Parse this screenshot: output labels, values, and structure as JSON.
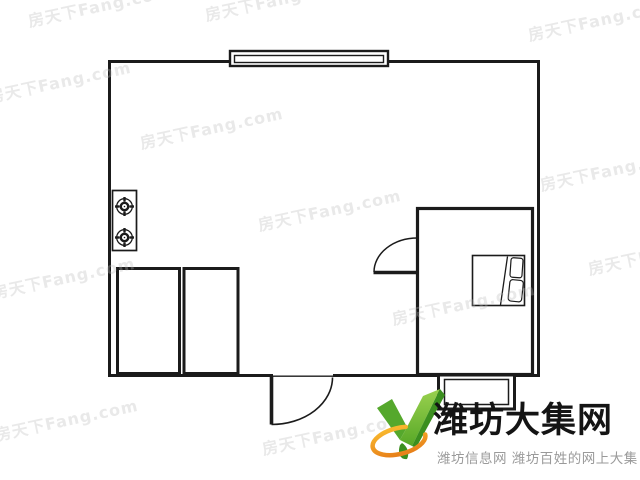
{
  "canvas": {
    "width": 640,
    "height": 480,
    "background": "#ffffff"
  },
  "floorplan": {
    "line_color": "#1b1b1b",
    "fill_color": "#ffffff",
    "elements": [
      {
        "name": "outer-walls",
        "type": "walls"
      },
      {
        "name": "window-top",
        "type": "window"
      },
      {
        "name": "gas-stove",
        "type": "appliance",
        "burners": 2
      },
      {
        "name": "closet-left",
        "type": "furniture"
      },
      {
        "name": "closet-right",
        "type": "furniture"
      },
      {
        "name": "entry-door",
        "type": "door-swing"
      },
      {
        "name": "bedroom",
        "type": "room"
      },
      {
        "name": "bedroom-door",
        "type": "door-swing"
      },
      {
        "name": "bed",
        "type": "furniture",
        "pillows": 2
      },
      {
        "name": "balcony-window",
        "type": "window"
      }
    ]
  },
  "watermark": {
    "text": "房天下Fang.com",
    "color": "rgba(187,187,187,0.32)",
    "rotation_deg": -12,
    "font_size": 16,
    "positions": [
      [
        28,
        8
      ],
      [
        205,
        2
      ],
      [
        528,
        22
      ],
      [
        -12,
        84
      ],
      [
        140,
        130
      ],
      [
        540,
        172
      ],
      [
        258,
        212
      ],
      [
        -8,
        280
      ],
      [
        392,
        306
      ],
      [
        588,
        256
      ],
      [
        -5,
        422
      ],
      [
        262,
        436
      ]
    ]
  },
  "logo": {
    "title": "潍坊大集网",
    "subtitle": "潍坊信息网 潍坊百姓的网上大集",
    "title_color": "#141414",
    "subtitle_color": "#9a9a9a",
    "mark_green_light": "#8dc63f",
    "mark_green": "#55a82c",
    "mark_green_dark": "#3b8f1f",
    "mark_orange": "#f29b1d",
    "mark_orange_light": "#f8b62d"
  }
}
